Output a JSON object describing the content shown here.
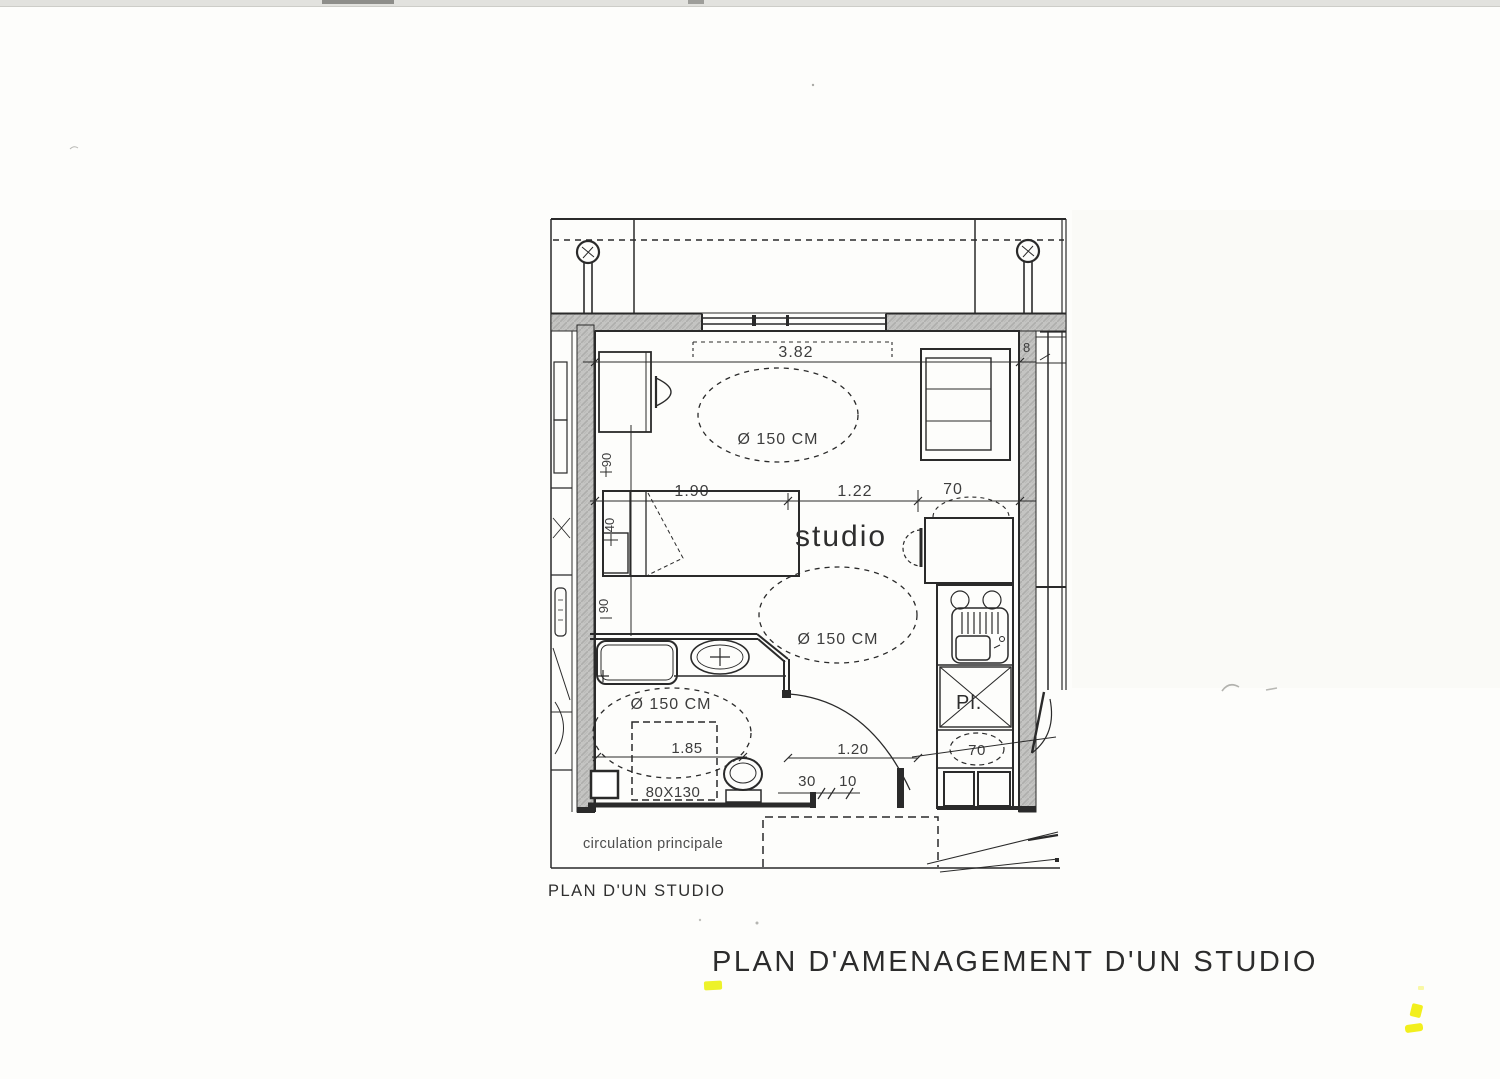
{
  "titles": {
    "main_title": "PLAN D'AMENAGEMENT D'UN STUDIO",
    "plan_caption": "PLAN D'UN STUDIO"
  },
  "plan": {
    "room_label": "studio",
    "circulation_label": "circulation principale",
    "closet_label": "Pl.",
    "turning_circle_label": "Ø 150 CM",
    "dimensions": {
      "window_width": "3.82",
      "bed_width": "1.90",
      "passage_width": "1.22",
      "kitchen_depth": "70",
      "bath_width": "1.85",
      "hall_width": "1.20",
      "dim_30": "30",
      "dim_10": "10",
      "shower_size": "80X130",
      "door_clear": "70",
      "wall_dim_90_upper": "90",
      "bed_side_40": "40",
      "wall_dim_90_lower": "90",
      "wall_mark_8": "8"
    }
  },
  "colors": {
    "ink": "#2a2a2a",
    "wall_gray": "#c4c4c2",
    "highlight_yellow": "#edf22a",
    "paper": "#fdfdfb"
  }
}
